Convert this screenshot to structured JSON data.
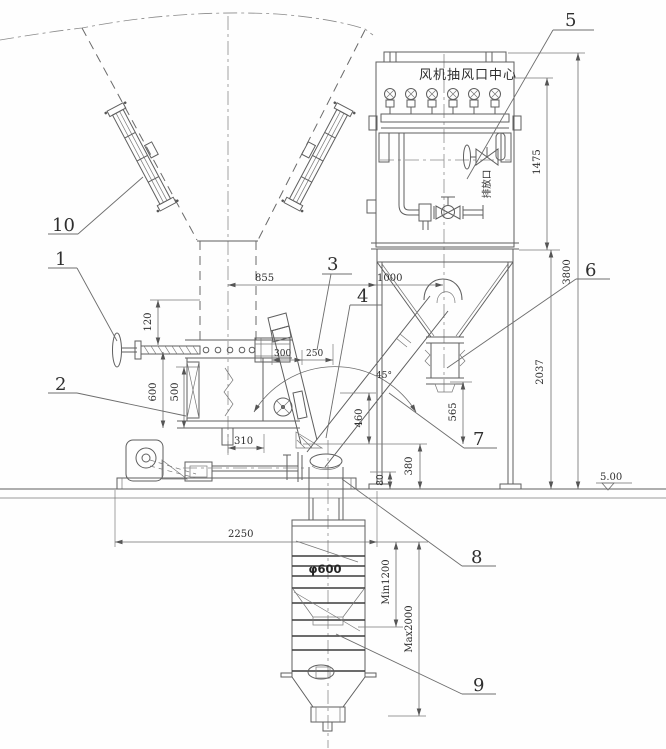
{
  "drawing": {
    "callouts": {
      "c1": "1",
      "c2": "2",
      "c3": "3",
      "c4": "4",
      "c5": "5",
      "c6": "6",
      "c7": "7",
      "c8": "8",
      "c9": "9",
      "c10": "10"
    },
    "dims": {
      "d855": "855",
      "d1000": "1000",
      "d120": "120",
      "d600": "600",
      "d500": "500",
      "d310": "310",
      "d300": "300",
      "d250": "250",
      "d45": "45°",
      "d460": "460",
      "d565": "565",
      "d380": "380",
      "d80": "80",
      "d2250": "2250",
      "d600dia": "φ600",
      "dmin": "Min1200",
      "dmax": "Max2000",
      "d1475": "1475",
      "d2037": "2037",
      "d3800": "3800",
      "dlevel": "5.00"
    },
    "labels": {
      "fan_center": "风机抽风口中心",
      "drain_port": "排放口"
    }
  }
}
